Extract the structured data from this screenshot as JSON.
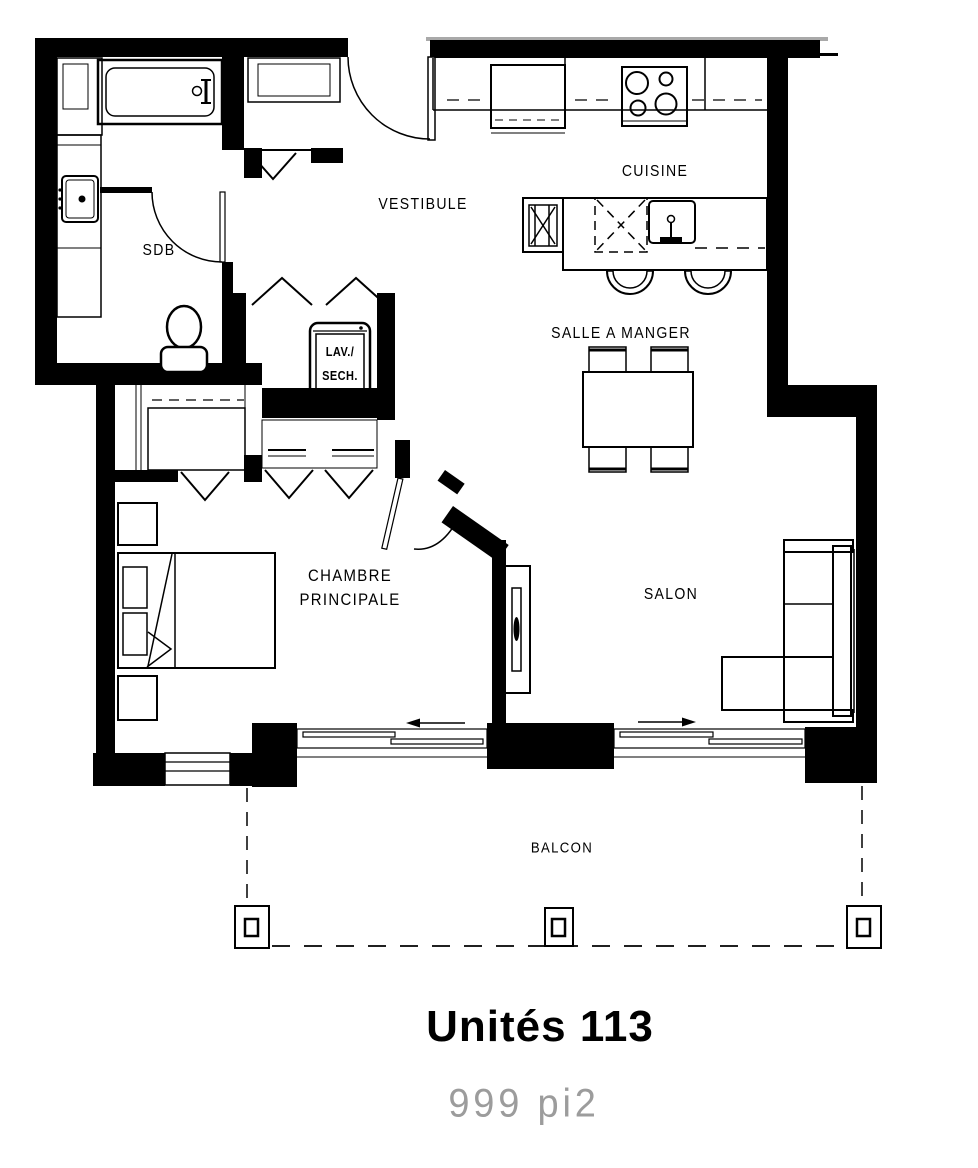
{
  "title": {
    "unit": "Unités 113",
    "area": "999 pi2"
  },
  "plan_labels": {
    "sdb": "SDB",
    "vestibule": "VESTIBULE",
    "cuisine": "CUISINE",
    "salle_a_manger": "SALLE A MANGER",
    "lav_line1": "LAV./",
    "lav_line2": "SECH.",
    "chambre_line1": "CHAMBRE",
    "chambre_line2": "PRINCIPALE",
    "salon": "SALON",
    "balcon": "BALCON"
  },
  "rooms": [
    "SDB",
    "VESTIBULE",
    "CUISINE",
    "SALLE A MANGER",
    "CHAMBRE PRINCIPALE",
    "SALON",
    "BALCON"
  ],
  "colors": {
    "walls": "#000000",
    "lines": "#000000",
    "area_text": "#9c9c9c",
    "background": "#ffffff",
    "top_band_cap": "#a9a9a9"
  }
}
